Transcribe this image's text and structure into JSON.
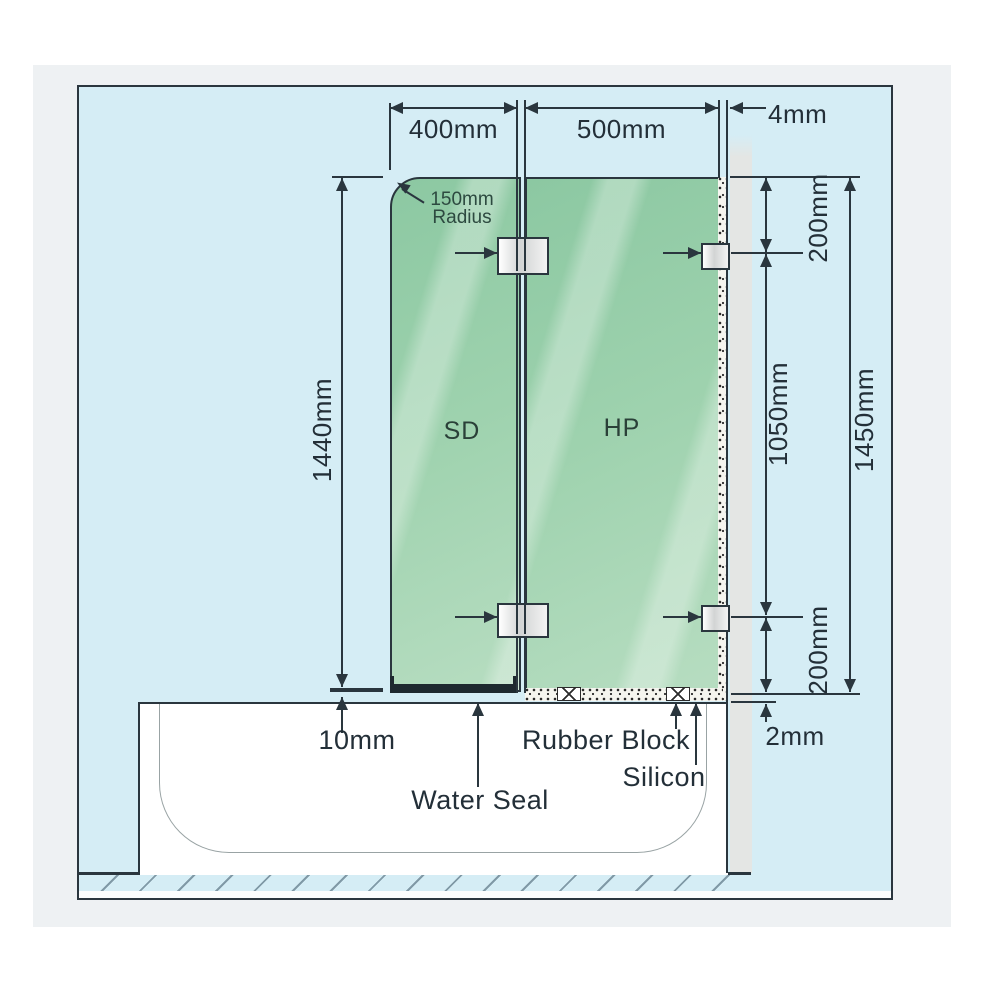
{
  "diagram": {
    "dimensions": {
      "panel_sd_width": "400mm",
      "panel_hp_width": "500mm",
      "wall_gap": "4mm",
      "sd_height": "1440mm",
      "hinge_top_offset": "200mm",
      "hinge_spacing": "1050mm",
      "hp_height": "1450mm",
      "hinge_bottom_offset": "200mm",
      "glass_to_tub_gap": "10mm",
      "tub_edge_gap": "2mm"
    },
    "corner_radius": {
      "line1": "150mm",
      "line2": "Radius"
    },
    "panels": {
      "sd": "SD",
      "hp": "HP"
    },
    "callouts": {
      "water_seal": "Water Seal",
      "rubber_block": "Rubber Block",
      "silicon": "Silicon"
    },
    "colors": {
      "background_blue": "#d5edf5",
      "glass_green": "#9dd1ad",
      "wall_gray": "#e4e6e4",
      "line_ink": "#2a363e",
      "card_gray": "#eef1f3"
    }
  }
}
